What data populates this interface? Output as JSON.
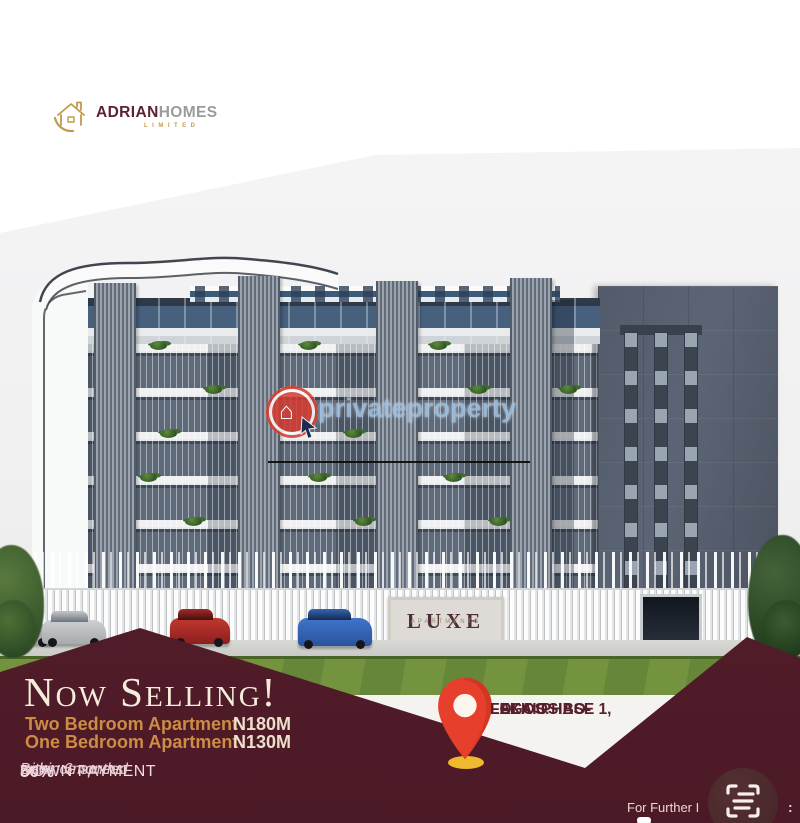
{
  "brand": {
    "name_bold": "ADRIAN",
    "name_light": "HOMES",
    "subtitle": "LIMITED"
  },
  "watermark": {
    "text": "privateproperty"
  },
  "building": {
    "sign_title": "LUXE",
    "sign_subtitle": "APARTMENTS"
  },
  "promo": {
    "headline": "Now Selling!",
    "offers": [
      {
        "label": "Two Bedroom Apartment",
        "price": "N180M"
      },
      {
        "label": "One Bedroom Apartment",
        "price": "N130M"
      }
    ],
    "payment": {
      "percent": "50%",
      "title": "DOWN PAYMENT",
      "note_line1": "Balance spread",
      "note_line2": "within 6months"
    }
  },
  "location": {
    "line1": "FOLA OSIBO-",
    "line2": "LEKKI PHASE 1,",
    "line3": "LAGOS."
  },
  "footer": {
    "inquiries_text": "For Further I",
    "colon": ":"
  },
  "colors": {
    "maroon": "#57202d",
    "gold": "#cd8c45",
    "cream": "#ece0cb",
    "pin_red": "#e63f2b",
    "brand_maroon": "#5a2330",
    "brand_gray": "#999b9d",
    "brand_gold": "#c2a04f",
    "watermark_blue": "#96bee1"
  }
}
